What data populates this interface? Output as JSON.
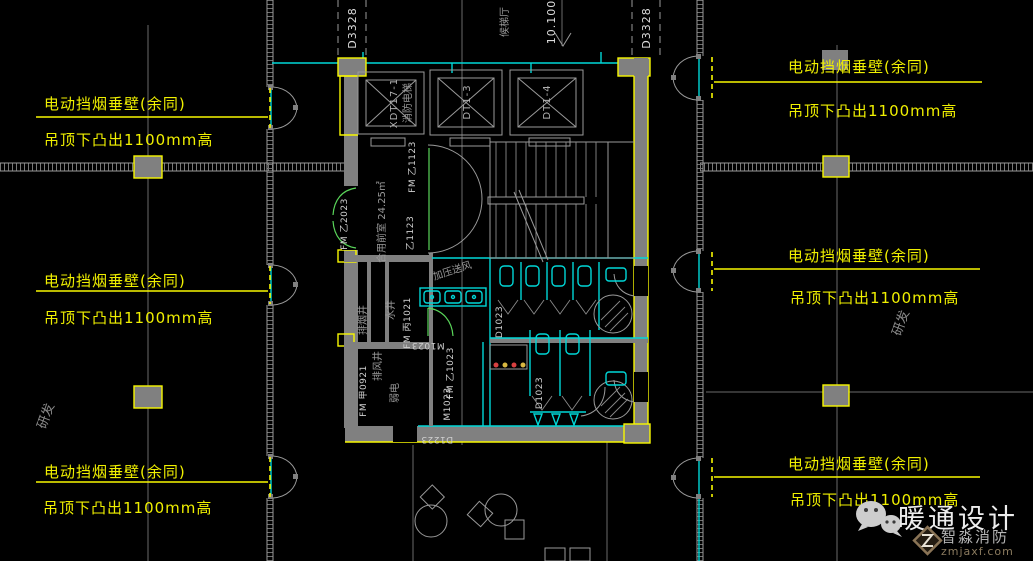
{
  "callout": {
    "line1": "电动挡烟垂壁(余同)",
    "line2": "吊顶下凸出1100mm高"
  },
  "axes": {
    "left": "D3328",
    "right": "D3328",
    "level": "10.100"
  },
  "rooms": {
    "elevator_lobby": "候梯厅",
    "shared_front_room": "合用前室 24.25㎡",
    "rd_left": "研发",
    "rd_right": "研发",
    "smoke_exhaust_shaft": "排烟井",
    "water_shaft": "水井",
    "exhaust_shaft": "排风井",
    "elv_room": "弱电",
    "pressurized_supply": "加压送风"
  },
  "elevators": {
    "fire_id": "XDT17-1",
    "fire_name": "消防电梯",
    "car2": "DT1-3",
    "car3": "DT1-4"
  },
  "doors": {
    "fm_b2023": "FM 乙2023",
    "fm_b1123": "FM 乙1123",
    "b1123": "乙1123",
    "fm_c1021": "FM 丙1021",
    "fm_a0921": "FM 甲0921",
    "fm_b1023": "FM 乙1023",
    "m1023_a": "M1023",
    "m1023_b": "M1023",
    "d1023_a": "D1023",
    "d1023_b": "D1023",
    "d1223": "D1223"
  },
  "watermark": {
    "title": "暖通设计",
    "brand": "智淼消防",
    "url": "zmjaxf.com"
  },
  "colors": {
    "background": "#000000",
    "annotation_yellow": "#f7f700",
    "wall_gray": "#808080",
    "line_gray": "#9a9a9a",
    "cad_cyan": "#00d7d7",
    "door_green": "#5ad65a"
  }
}
